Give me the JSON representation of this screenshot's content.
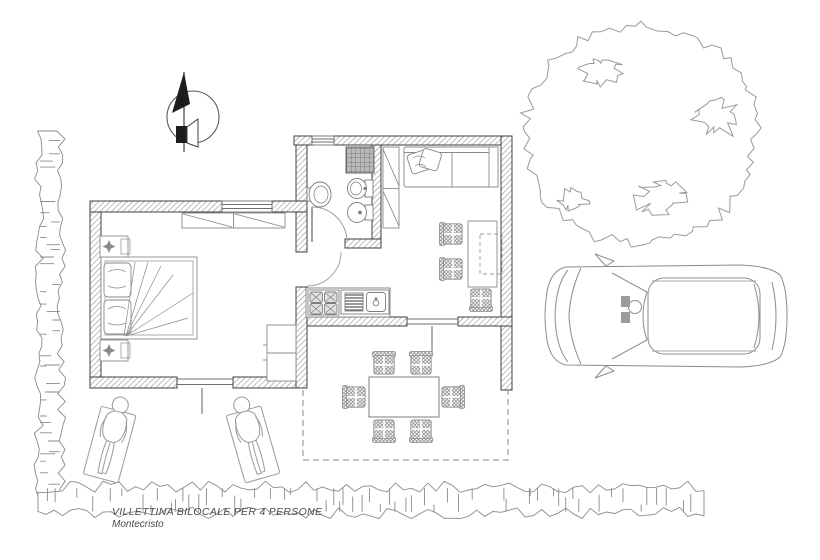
{
  "drawing": {
    "title": "VILLETTINA BILOCALE PER 4 PERSONE",
    "subtitle": "Montecristo"
  },
  "symbols": {
    "north_arrow": "north-arrow-icon",
    "tree": "tree-canopy-top-view",
    "car": "car-top-view",
    "stone_wall": "rough-stone-garden-wall",
    "terrace_boundary": "dashed-patio-outline"
  },
  "colors": {
    "background": "#ffffff",
    "wall_outline": "#3f3f3f",
    "wall_hatch": "#9a9a9a",
    "furniture_line": "#8a8a8a",
    "light_line": "#a0a0a0",
    "shower_fill": "#b9b9b9",
    "text": "#4a4a4a"
  }
}
